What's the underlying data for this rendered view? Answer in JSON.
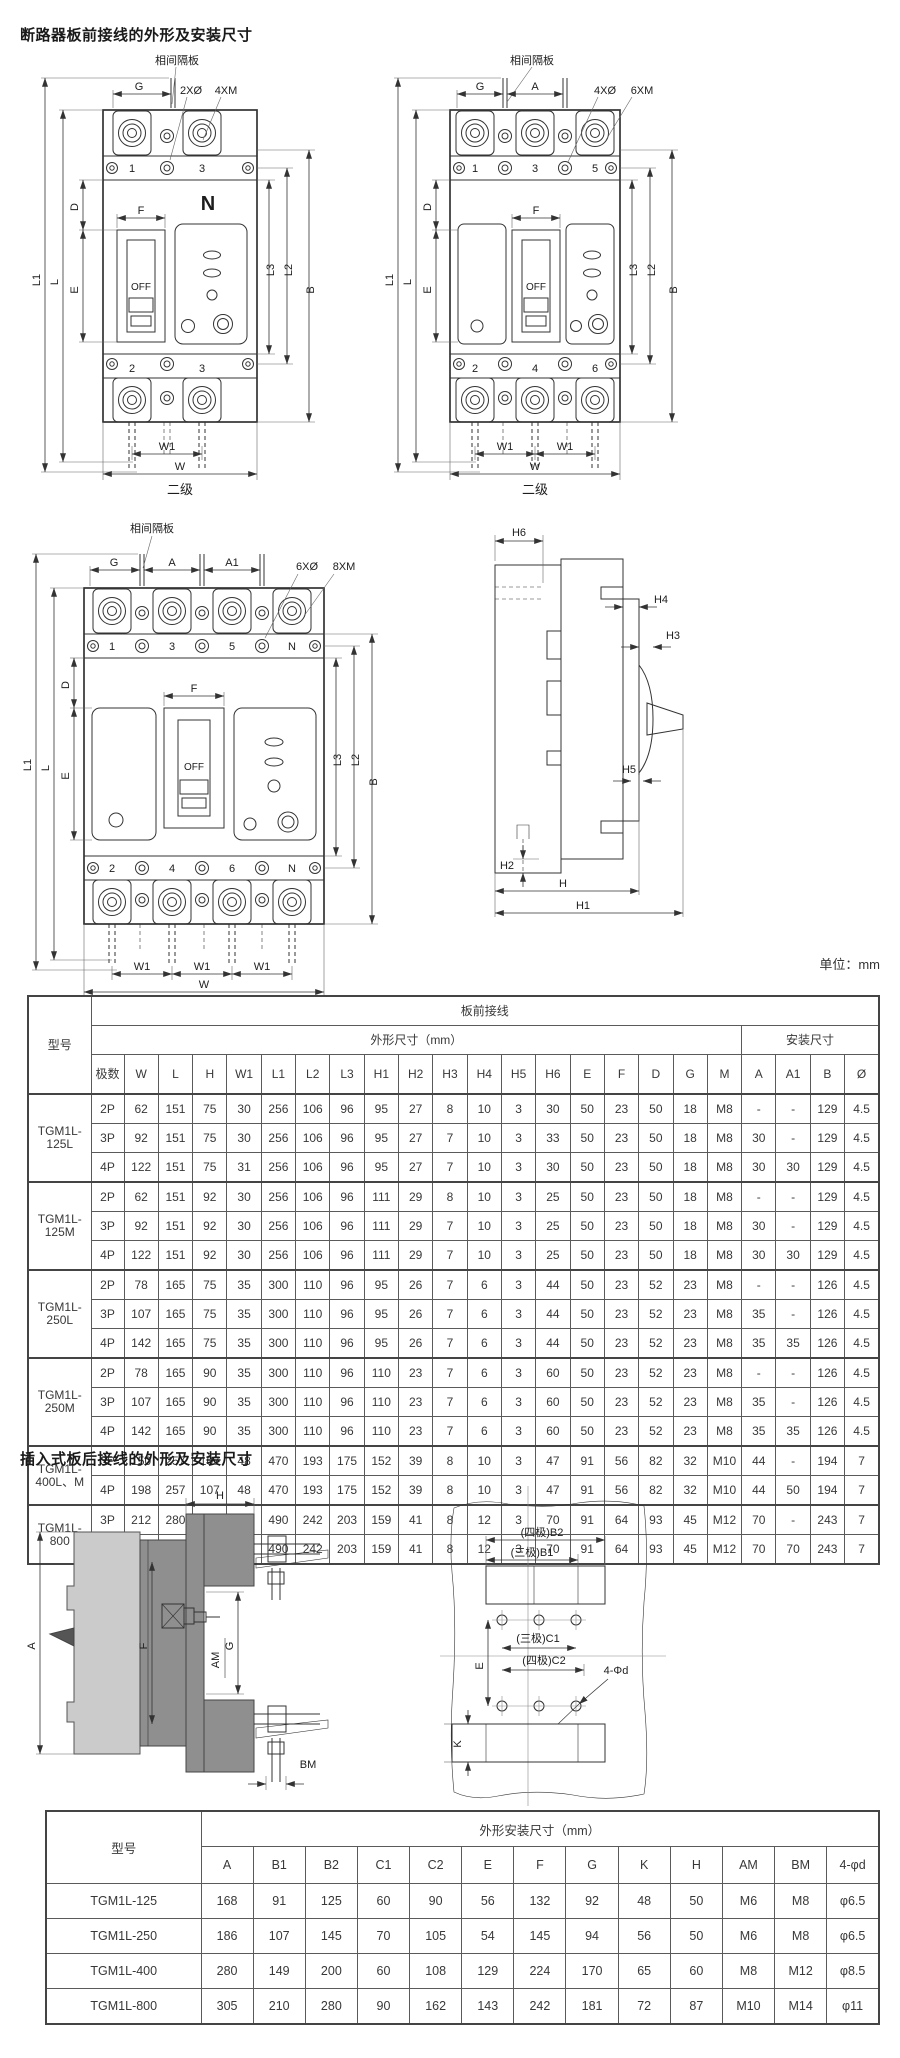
{
  "page": {
    "title1": "断路器板前接线的外形及安装尺寸",
    "title2": "插入式板后接线的外形及安装尺寸",
    "unit": "单位：mm"
  },
  "drawings": {
    "front2p": {
      "barrier": "相间隔板",
      "g": "G",
      "holes1": "2XØ",
      "holes2": "4XM",
      "t1": "1",
      "t3": "3",
      "n": "N",
      "f": "F",
      "off": "OFF",
      "l1": "L1",
      "l": "L",
      "d": "D",
      "e": "E",
      "l3": "L3",
      "l2": "L2",
      "b": "B",
      "b2": "2",
      "b3": "3",
      "w1": "W1",
      "w": "W",
      "caption": "二级"
    },
    "front3p": {
      "barrier": "相间隔板",
      "g": "G",
      "a": "A",
      "holes1": "4XØ",
      "holes2": "6XM",
      "t1": "1",
      "t3": "3",
      "t5": "5",
      "f": "F",
      "off": "OFF",
      "l1": "L1",
      "l": "L",
      "d": "D",
      "e": "E",
      "l3": "L3",
      "l2": "L2",
      "b": "B",
      "b2": "2",
      "b4": "4",
      "b6": "6",
      "w1a": "W1",
      "w1b": "W1",
      "w": "W",
      "caption": "二级"
    },
    "front4p": {
      "barrier": "相间隔板",
      "g": "G",
      "a": "A",
      "a1": "A1",
      "holes1": "6XØ",
      "holes2": "8XM",
      "t1": "1",
      "t3": "3",
      "t5": "5",
      "tn": "N",
      "f": "F",
      "off": "OFF",
      "l1": "L1",
      "l": "L",
      "d": "D",
      "e": "E",
      "l3": "L3",
      "l2": "L2",
      "b": "B",
      "b2": "2",
      "b4": "4",
      "b6": "6",
      "bn": "N",
      "w1a": "W1",
      "w1b": "W1",
      "w1c": "W1",
      "w": "W",
      "caption": "四级"
    },
    "side": {
      "h6": "H6",
      "h4": "H4",
      "h3": "H3",
      "h5": "H5",
      "h2": "H2",
      "h": "H",
      "h1": "H1"
    },
    "plug": {
      "h": "H",
      "a": "A",
      "f": "F",
      "am": "AM",
      "g": "G",
      "bm": "BM"
    },
    "cut": {
      "b2": "(四极)B2",
      "b1": "(三极)B1",
      "c1": "(三极)C1",
      "c2": "(四极)C2",
      "e": "E",
      "k": "K",
      "holes": "4-Φd"
    }
  },
  "table1": {
    "corner": "型号",
    "group": "板前接线",
    "sub1": "外形尺寸（mm）",
    "sub2": "安装尺寸",
    "cols": [
      "极数",
      "W",
      "L",
      "H",
      "W1",
      "L1",
      "L2",
      "L3",
      "H1",
      "H2",
      "H3",
      "H4",
      "H5",
      "H6",
      "E",
      "F",
      "D",
      "G",
      "M",
      "A",
      "A1",
      "B",
      "Ø"
    ],
    "groups": [
      {
        "model": "TGM1L-125L",
        "rows": [
          [
            "2P",
            "62",
            "151",
            "75",
            "30",
            "256",
            "106",
            "96",
            "95",
            "27",
            "8",
            "10",
            "3",
            "30",
            "50",
            "23",
            "50",
            "18",
            "M8",
            "-",
            "-",
            "129",
            "4.5"
          ],
          [
            "3P",
            "92",
            "151",
            "75",
            "30",
            "256",
            "106",
            "96",
            "95",
            "27",
            "7",
            "10",
            "3",
            "33",
            "50",
            "23",
            "50",
            "18",
            "M8",
            "30",
            "-",
            "129",
            "4.5"
          ],
          [
            "4P",
            "122",
            "151",
            "75",
            "31",
            "256",
            "106",
            "96",
            "95",
            "27",
            "7",
            "10",
            "3",
            "30",
            "50",
            "23",
            "50",
            "18",
            "M8",
            "30",
            "30",
            "129",
            "4.5"
          ]
        ]
      },
      {
        "model": "TGM1L-125M",
        "rows": [
          [
            "2P",
            "62",
            "151",
            "92",
            "30",
            "256",
            "106",
            "96",
            "111",
            "29",
            "8",
            "10",
            "3",
            "25",
            "50",
            "23",
            "50",
            "18",
            "M8",
            "-",
            "-",
            "129",
            "4.5"
          ],
          [
            "3P",
            "92",
            "151",
            "92",
            "30",
            "256",
            "106",
            "96",
            "111",
            "29",
            "7",
            "10",
            "3",
            "25",
            "50",
            "23",
            "50",
            "18",
            "M8",
            "30",
            "-",
            "129",
            "4.5"
          ],
          [
            "4P",
            "122",
            "151",
            "92",
            "30",
            "256",
            "106",
            "96",
            "111",
            "29",
            "7",
            "10",
            "3",
            "25",
            "50",
            "23",
            "50",
            "18",
            "M8",
            "30",
            "30",
            "129",
            "4.5"
          ]
        ]
      },
      {
        "model": "TGM1L-250L",
        "rows": [
          [
            "2P",
            "78",
            "165",
            "75",
            "35",
            "300",
            "110",
            "96",
            "95",
            "26",
            "7",
            "6",
            "3",
            "44",
            "50",
            "23",
            "52",
            "23",
            "M8",
            "-",
            "-",
            "126",
            "4.5"
          ],
          [
            "3P",
            "107",
            "165",
            "75",
            "35",
            "300",
            "110",
            "96",
            "95",
            "26",
            "7",
            "6",
            "3",
            "44",
            "50",
            "23",
            "52",
            "23",
            "M8",
            "35",
            "-",
            "126",
            "4.5"
          ],
          [
            "4P",
            "142",
            "165",
            "75",
            "35",
            "300",
            "110",
            "96",
            "95",
            "26",
            "7",
            "6",
            "3",
            "44",
            "50",
            "23",
            "52",
            "23",
            "M8",
            "35",
            "35",
            "126",
            "4.5"
          ]
        ]
      },
      {
        "model": "TGM1L-250M",
        "rows": [
          [
            "2P",
            "78",
            "165",
            "90",
            "35",
            "300",
            "110",
            "96",
            "110",
            "23",
            "7",
            "6",
            "3",
            "60",
            "50",
            "23",
            "52",
            "23",
            "M8",
            "-",
            "-",
            "126",
            "4.5"
          ],
          [
            "3P",
            "107",
            "165",
            "90",
            "35",
            "300",
            "110",
            "96",
            "110",
            "23",
            "7",
            "6",
            "3",
            "60",
            "50",
            "23",
            "52",
            "23",
            "M8",
            "35",
            "-",
            "126",
            "4.5"
          ],
          [
            "4P",
            "142",
            "165",
            "90",
            "35",
            "300",
            "110",
            "96",
            "110",
            "23",
            "7",
            "6",
            "3",
            "60",
            "50",
            "23",
            "52",
            "23",
            "M8",
            "35",
            "35",
            "126",
            "4.5"
          ]
        ]
      },
      {
        "model": "TGM1L-400L、M",
        "rows": [
          [
            "3P",
            "150",
            "257",
            "107",
            "48",
            "470",
            "193",
            "175",
            "152",
            "39",
            "8",
            "10",
            "3",
            "47",
            "91",
            "56",
            "82",
            "32",
            "M10",
            "44",
            "-",
            "194",
            "7"
          ],
          [
            "4P",
            "198",
            "257",
            "107",
            "48",
            "470",
            "193",
            "175",
            "152",
            "39",
            "8",
            "10",
            "3",
            "47",
            "91",
            "56",
            "82",
            "32",
            "M10",
            "44",
            "50",
            "194",
            "7"
          ]
        ]
      },
      {
        "model": "TGM1L-800",
        "rows": [
          [
            "3P",
            "212",
            "280",
            "116",
            "71",
            "490",
            "242",
            "203",
            "159",
            "41",
            "8",
            "12",
            "3",
            "70",
            "91",
            "64",
            "93",
            "45",
            "M12",
            "70",
            "-",
            "243",
            "7"
          ],
          [
            "4P",
            "283",
            "280",
            "116",
            "71",
            "490",
            "242",
            "203",
            "159",
            "41",
            "8",
            "12",
            "3",
            "70",
            "91",
            "64",
            "93",
            "45",
            "M12",
            "70",
            "70",
            "243",
            "7"
          ]
        ]
      }
    ]
  },
  "table2": {
    "corner": "型号",
    "header": "外形安装尺寸（mm）",
    "cols": [
      "A",
      "B1",
      "B2",
      "C1",
      "C2",
      "E",
      "F",
      "G",
      "K",
      "H",
      "AM",
      "BM",
      "4-φd"
    ],
    "rows": [
      {
        "model": "TGM1L-125",
        "values": [
          "168",
          "91",
          "125",
          "60",
          "90",
          "56",
          "132",
          "92",
          "48",
          "50",
          "M6",
          "M8",
          "φ6.5"
        ]
      },
      {
        "model": "TGM1L-250",
        "values": [
          "186",
          "107",
          "145",
          "70",
          "105",
          "54",
          "145",
          "94",
          "56",
          "50",
          "M6",
          "M8",
          "φ6.5"
        ]
      },
      {
        "model": "TGM1L-400",
        "values": [
          "280",
          "149",
          "200",
          "60",
          "108",
          "129",
          "224",
          "170",
          "65",
          "60",
          "M8",
          "M12",
          "φ8.5"
        ]
      },
      {
        "model": "TGM1L-800",
        "values": [
          "305",
          "210",
          "280",
          "90",
          "162",
          "143",
          "242",
          "181",
          "72",
          "87",
          "M10",
          "M14",
          "φ11"
        ]
      }
    ]
  }
}
